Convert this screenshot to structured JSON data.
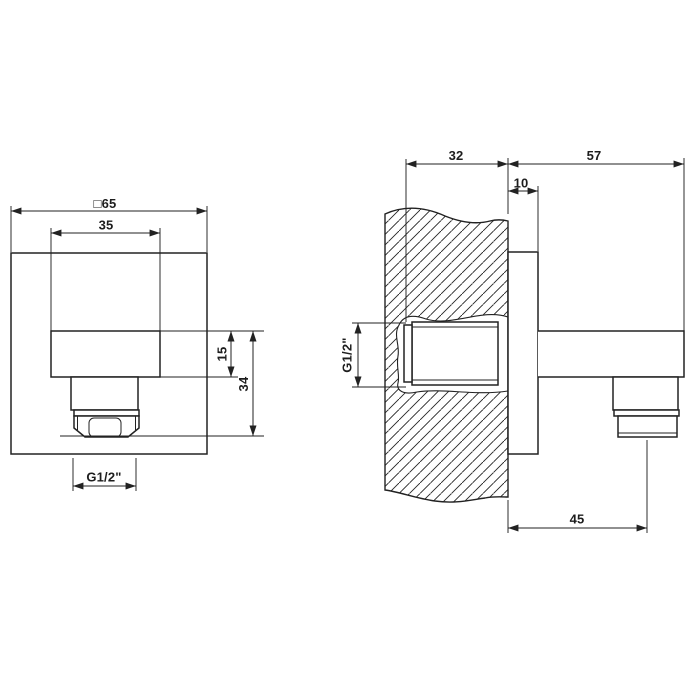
{
  "colors": {
    "line": "#222222",
    "background": "#ffffff"
  },
  "front_view": {
    "dim_plate": "□65",
    "dim_body_width": "35",
    "dim_body_height": "15",
    "dim_overall_height": "34",
    "dim_outlet_thread": "G1/2\""
  },
  "side_view": {
    "dim_recess_depth": "32",
    "dim_projection": "57",
    "dim_plate_thickness": "10",
    "dim_inlet_thread": "G1/2\"",
    "dim_outlet_distance": "45"
  }
}
